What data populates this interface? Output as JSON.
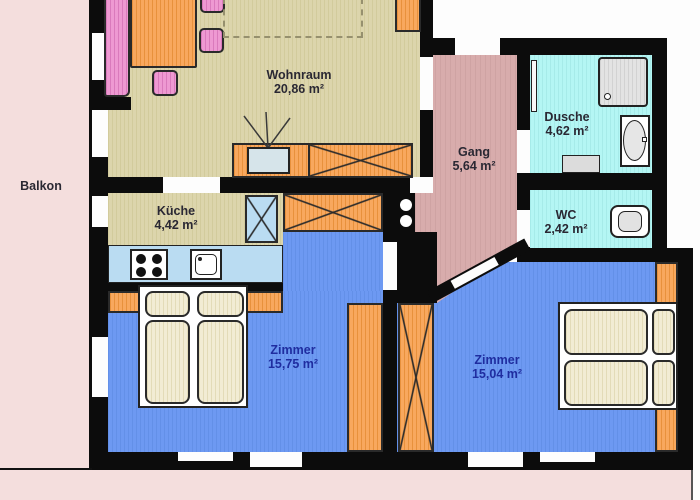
{
  "rooms": {
    "balkon": {
      "label": "Balkon"
    },
    "wohnraum": {
      "label": "Wohnraum",
      "area": "20,86 m²"
    },
    "kueche": {
      "label": "Küche",
      "area": "4,42 m²"
    },
    "gang": {
      "label": "Gang",
      "area": "5,64 m²"
    },
    "dusche": {
      "label": "Dusche",
      "area": "4,62 m²"
    },
    "wc": {
      "label": "WC",
      "area": "2,42 m²"
    },
    "zimmer_links": {
      "label": "Zimmer",
      "area": "15,75 m²"
    },
    "zimmer_rechts": {
      "label": "Zimmer",
      "area": "15,04 m²"
    }
  },
  "colors": {
    "wall": "#0c0c0c",
    "living_floor": "#dcd5ac",
    "bedroom_floor": "#6d99f2",
    "hallway_floor": "#d8acac",
    "bathroom_floor": "#b4f6f4",
    "balcony": "#f4dedd",
    "furniture_orange": "#f8a85e",
    "furniture_pink": "#ee99d2",
    "kitchen_counter": "#badcf2",
    "mattress_cream": "#f2ecd4",
    "label_dark": "#2a2833",
    "label_blue": "#1f2da0"
  }
}
